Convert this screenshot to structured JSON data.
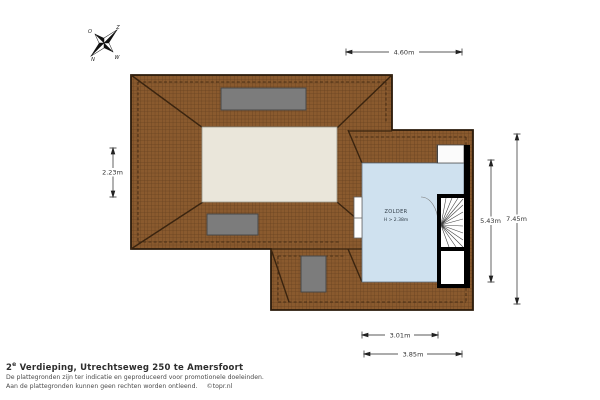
{
  "title_block": {
    "title_prefix": "2",
    "title_superscript": "e",
    "title_rest": " Verdieping, Utrechtseweg 250 te Amersfoort",
    "disclaimer_line1": "De plattegronden zijn ter indicatie en geproduceerd voor promotionele doeleinden.",
    "disclaimer_line2": "Aan de plattegronden kunnen geen rechten worden ontleend.",
    "credit": "©topr.nl"
  },
  "compass": {
    "east": "O",
    "south": "Z",
    "north": "N",
    "west": "W"
  },
  "room": {
    "name": "ZOLDER",
    "height_note": "H > 2.38m"
  },
  "dimensions": {
    "top": "4.60m",
    "left": "2.23m",
    "right_inner": "5.43m",
    "right_outer": "7.45m",
    "bottom_inner": "3.01m",
    "bottom_outer": "3.85m"
  },
  "colors": {
    "roof_brown": "#8a5a2e",
    "roof_grid_line": "#65401f",
    "roof_outline": "#2a1a0a",
    "flat_roof_cream": "#eae6da",
    "dormer_gray": "#7c7c7c",
    "room_blue": "#cfe1ef",
    "wall_black": "#000000",
    "dimension_gray": "#222222"
  }
}
